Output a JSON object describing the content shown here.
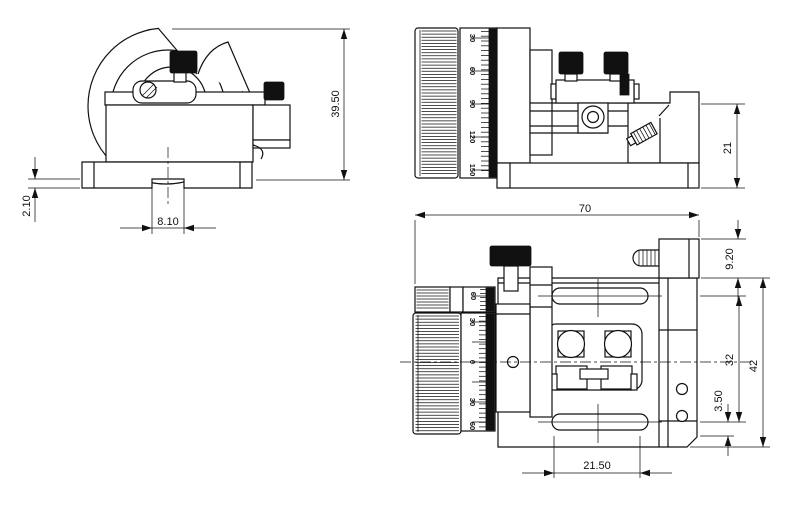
{
  "drawing": {
    "front_view": {
      "dim_total_height": "39.50",
      "dim_step_depth": "2.10",
      "dim_slot_width": "8.10"
    },
    "side_view": {
      "dim_block_height": "21",
      "drum_labels": [
        "30",
        "60",
        "90",
        "120",
        "150"
      ]
    },
    "plan_view": {
      "dim_total_width": "70",
      "dim_stud_height": "9.20",
      "dim_slot_centers": "32",
      "dim_total_depth": "42",
      "dim_hole_offset": "3.50",
      "dim_slot_length": "21.50",
      "drum_labels": [
        "60",
        "30",
        "0",
        "30",
        "60"
      ]
    }
  }
}
